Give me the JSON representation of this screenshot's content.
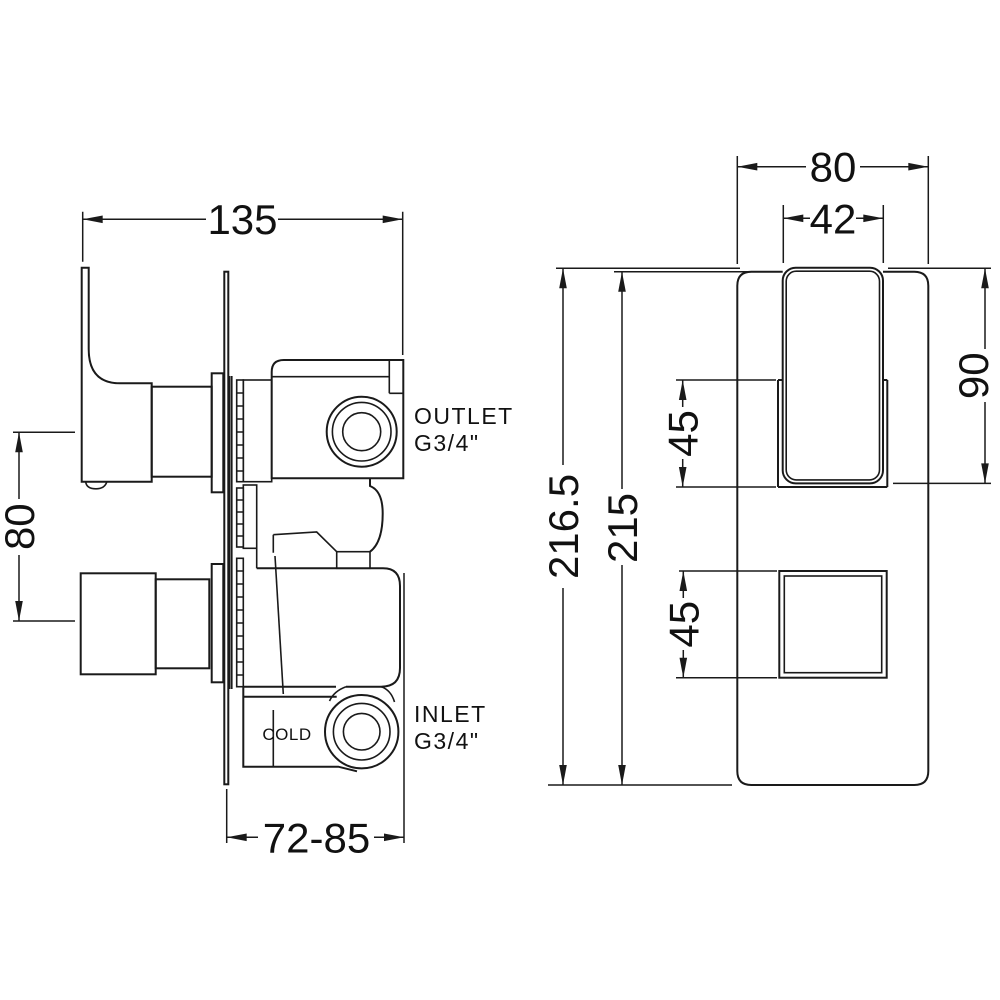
{
  "drawing": {
    "title": "concealed thermostatic shower valve dimension drawing",
    "colors": {
      "line": "#1a1a1a",
      "background": "#ffffff"
    },
    "side_view": {
      "dim_width": "135",
      "dim_port_spacing": "80",
      "dim_depth": "72-85",
      "outlet_label_line1": "OUTLET",
      "outlet_label_line2": "G3/4\"",
      "inlet_label_line1": "INLET",
      "inlet_label_line2": "G3/4\"",
      "cold_label": "COLD"
    },
    "front_view": {
      "dim_plate_width": "80",
      "dim_handle_width": "42",
      "dim_handle_height": "90",
      "dim_escutcheon_height": "45",
      "dim_square_size": "45",
      "dim_total_height": "216.5",
      "dim_plate_height": "215"
    }
  }
}
